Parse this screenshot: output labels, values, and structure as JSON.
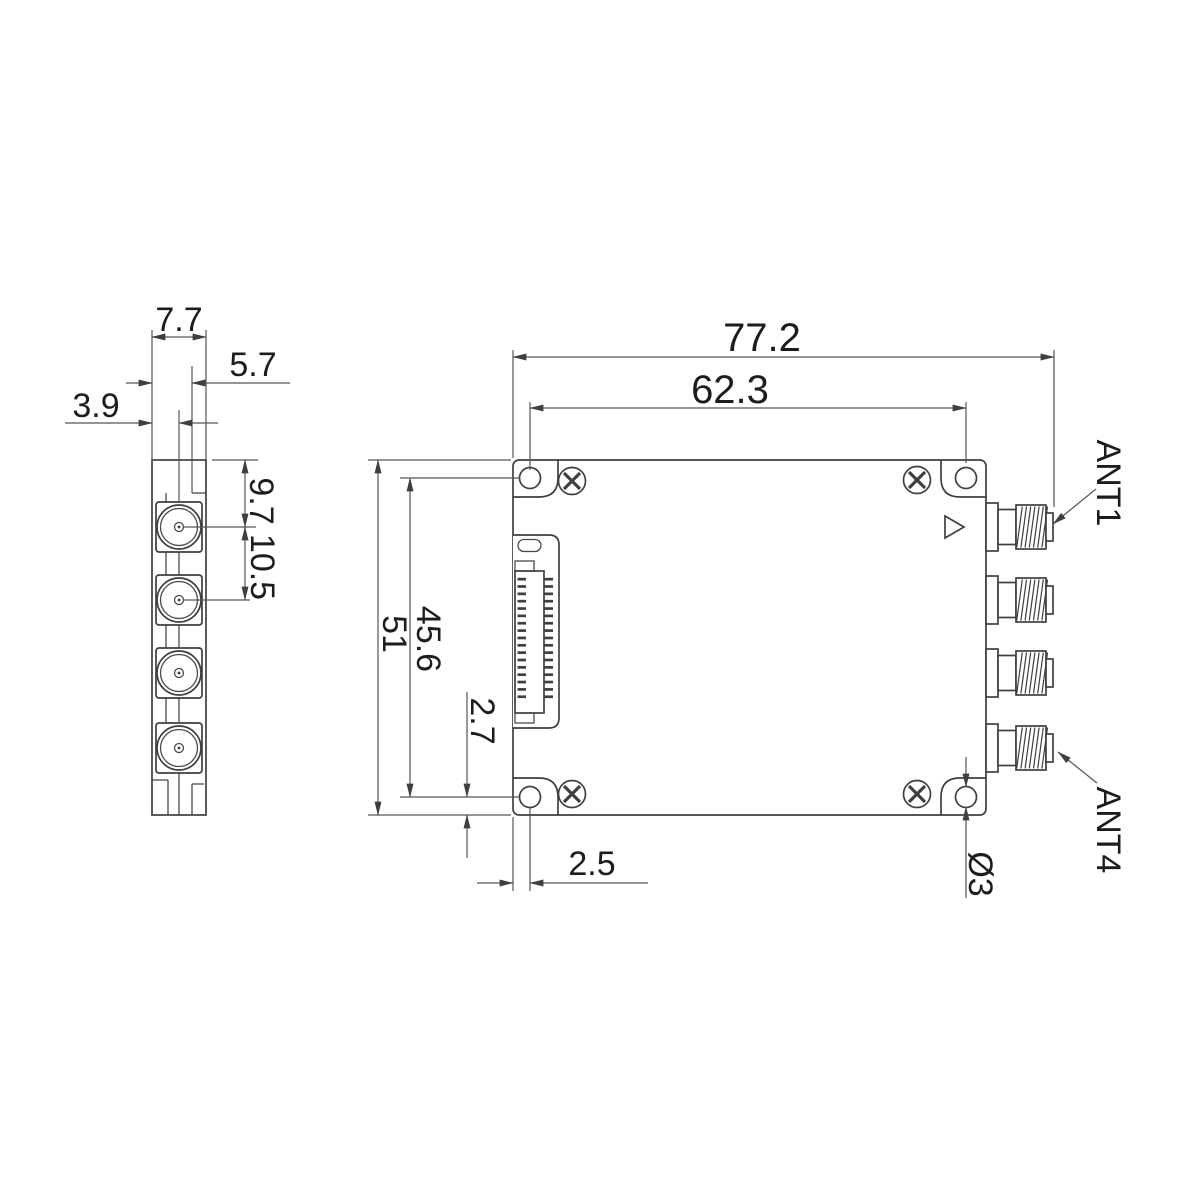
{
  "drawing": {
    "type": "mechanical-dimension-drawing",
    "unit_note": "millimetres",
    "dimensions": {
      "overall_width": "77.2",
      "hole_span_x": "62.3",
      "body_height": "51",
      "hole_span_y": "45.6",
      "hole_offset_bottom": "2.7",
      "hole_offset_left": "2.5",
      "side_thickness": "7.7",
      "side_inner_offset": "5.7",
      "side_center_offset": "3.9",
      "connector_top_offset": "9.7",
      "connector_pitch": "10.5",
      "hole_diameter": "Ø3"
    },
    "annotations": {
      "ant1": "ANT1",
      "ant4": "ANT4"
    },
    "colors": {
      "line": "#3f3f3f",
      "dimension_line": "#555555",
      "text": "#1c1c1c",
      "background": "#ffffff"
    },
    "features": {
      "sma_connector_count": 4,
      "corner_hole_count": 4,
      "screw_count": 4
    }
  }
}
